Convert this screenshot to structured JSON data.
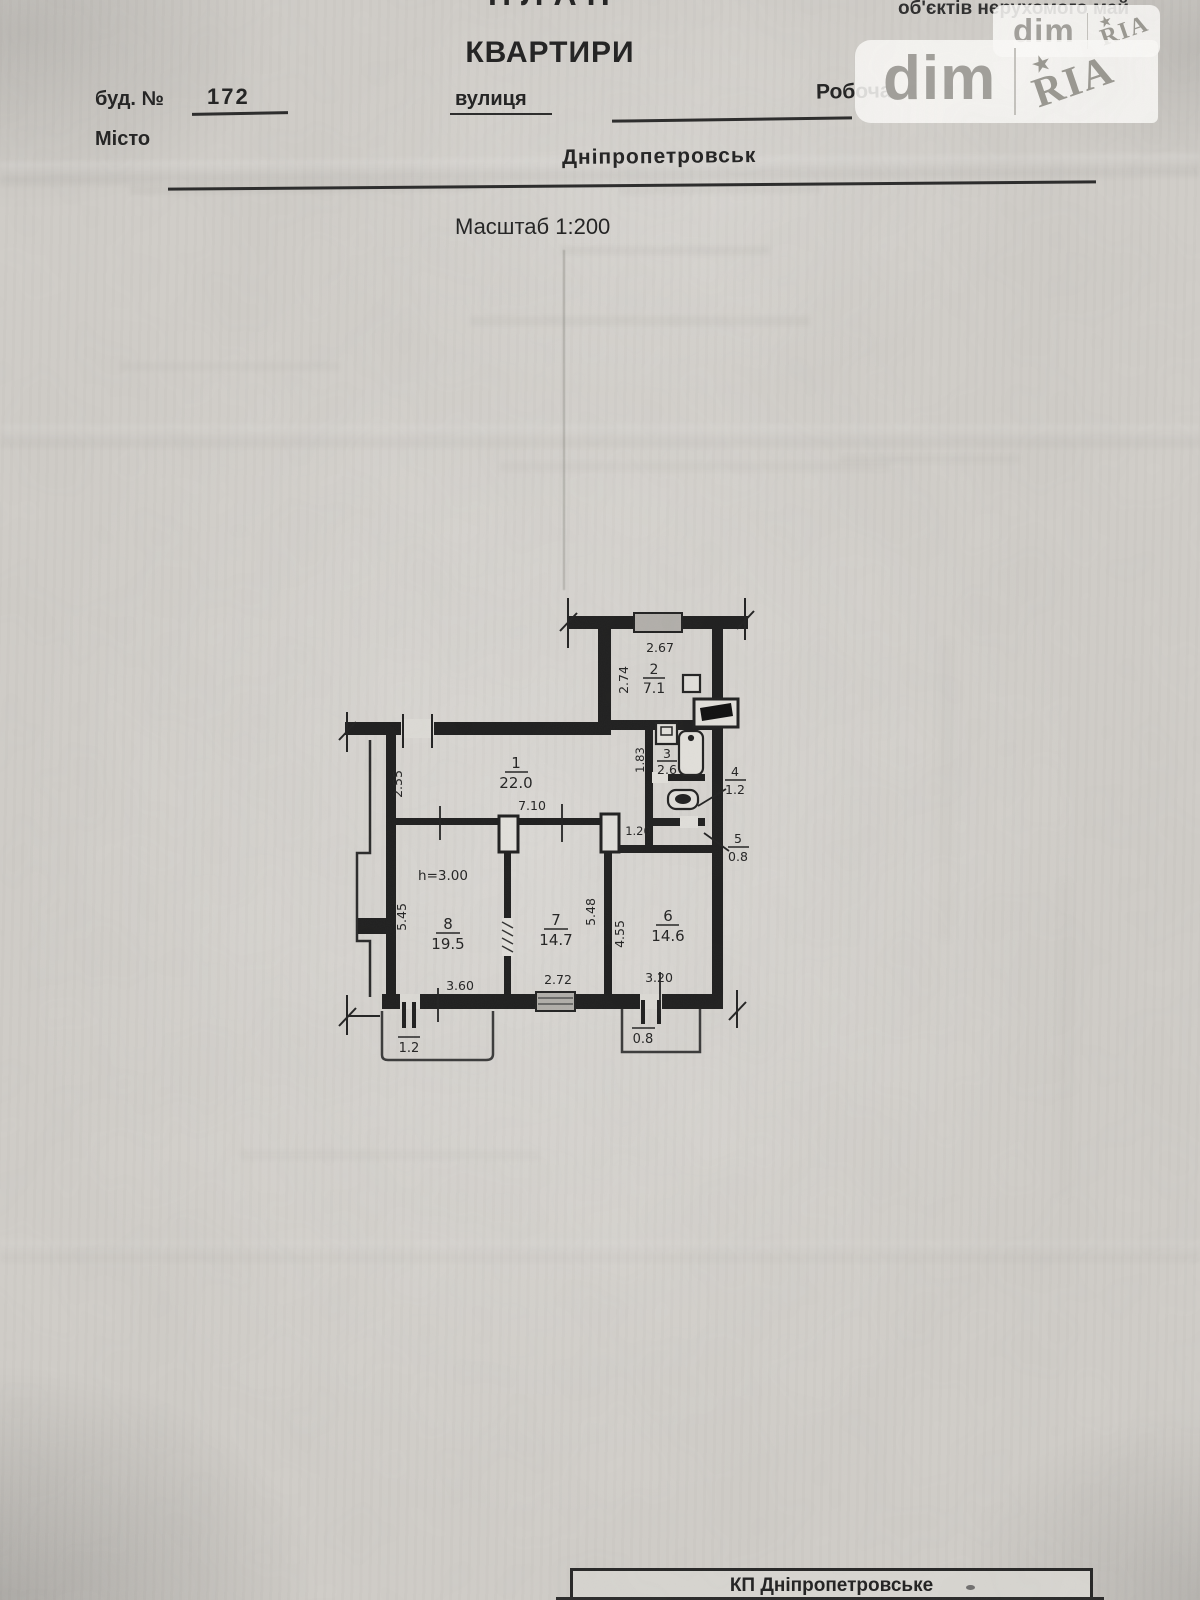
{
  "page": {
    "partial_top_title": "ПЛАН",
    "top_right_text": "об'єктів нерухомого май",
    "title": "КВАРТИРИ",
    "fields": {
      "building_label": "буд. №",
      "building_number": "172",
      "street_label": "вулиця",
      "street_value": "Робоча",
      "city_label": "Місто",
      "city_value": "Дніпропетровськ"
    },
    "scale_note": "Масштаб 1:200",
    "footer_text": "КП Дніпропетровське"
  },
  "watermark": {
    "dim_text": "dim",
    "ria_text": "RIA",
    "star": "★"
  },
  "plan": {
    "height_note": "h=3.00",
    "rooms": [
      {
        "number": "1",
        "area": "22.0"
      },
      {
        "number": "2",
        "area": "7.1"
      },
      {
        "number": "3",
        "area": "2.6"
      },
      {
        "number": "4",
        "area": "1.2"
      },
      {
        "number": "5",
        "area": "0.8"
      },
      {
        "number": "6",
        "area": "14.6"
      },
      {
        "number": "7",
        "area": "14.7"
      },
      {
        "number": "8",
        "area": "19.5"
      }
    ],
    "balconies": [
      {
        "area": "1.2"
      },
      {
        "area": "0.8"
      }
    ],
    "dimensions": {
      "d267": "2.67",
      "d274": "2.74",
      "d255": "2.55",
      "d710": "7.10",
      "d183": "1.83",
      "d120": "1.20",
      "d545": "5.45",
      "d360": "3.60",
      "d272": "2.72",
      "d548": "5.48",
      "d455": "4.55",
      "d320": "3.20"
    }
  },
  "colors": {
    "paper": "#d2cfca",
    "ink": "#222222",
    "watermark_gray": "#a2a09b"
  }
}
